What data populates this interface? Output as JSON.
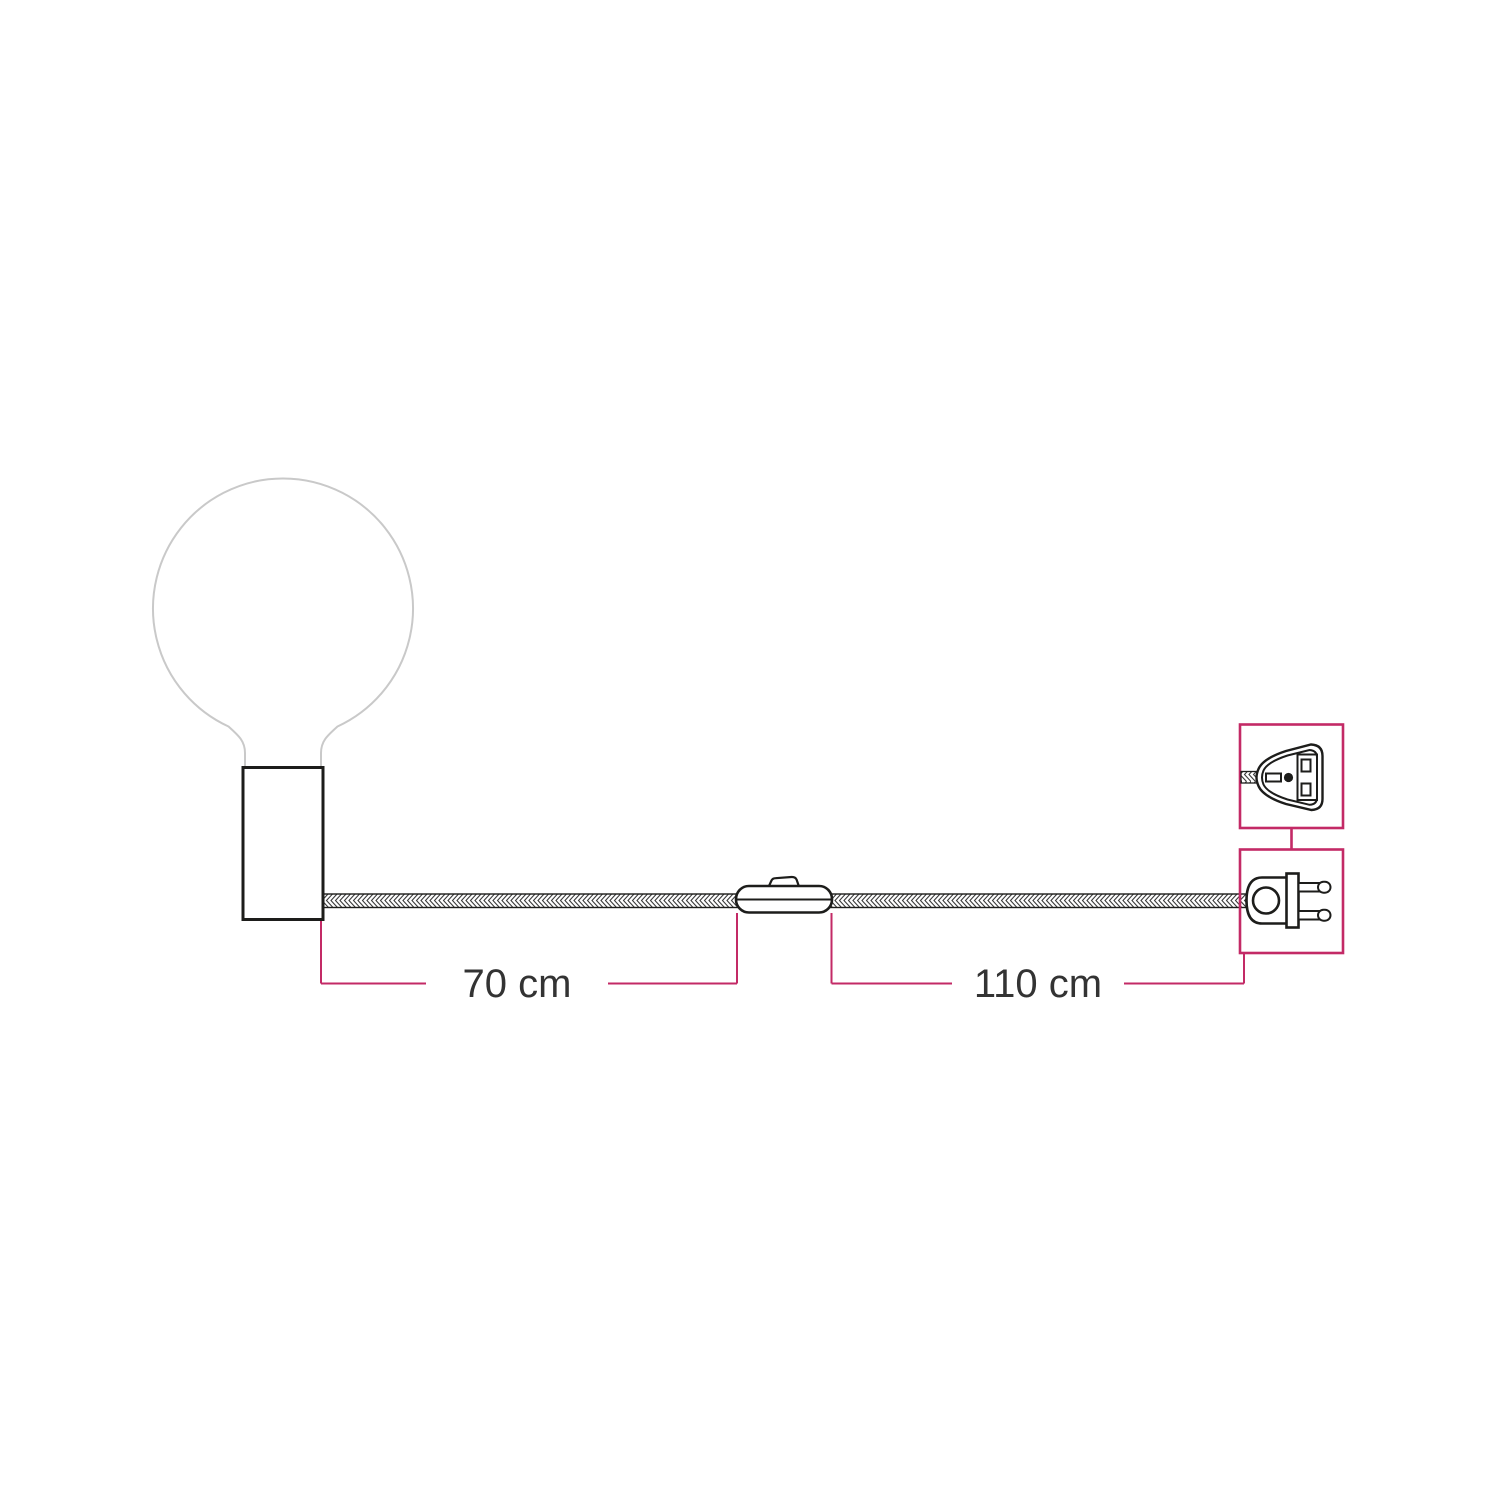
{
  "colors": {
    "background": "#ffffff",
    "accent": "#c32a66",
    "line": "#1d1d1b",
    "cable_stroke": "#3a3a3a",
    "bulb_outline": "#c9c9c9",
    "text": "#333333"
  },
  "dimensions": [
    {
      "name": "cable-length-holder-to-switch",
      "label": "70 cm"
    },
    {
      "name": "cable-length-switch-to-plug",
      "label": "110 cm"
    }
  ]
}
